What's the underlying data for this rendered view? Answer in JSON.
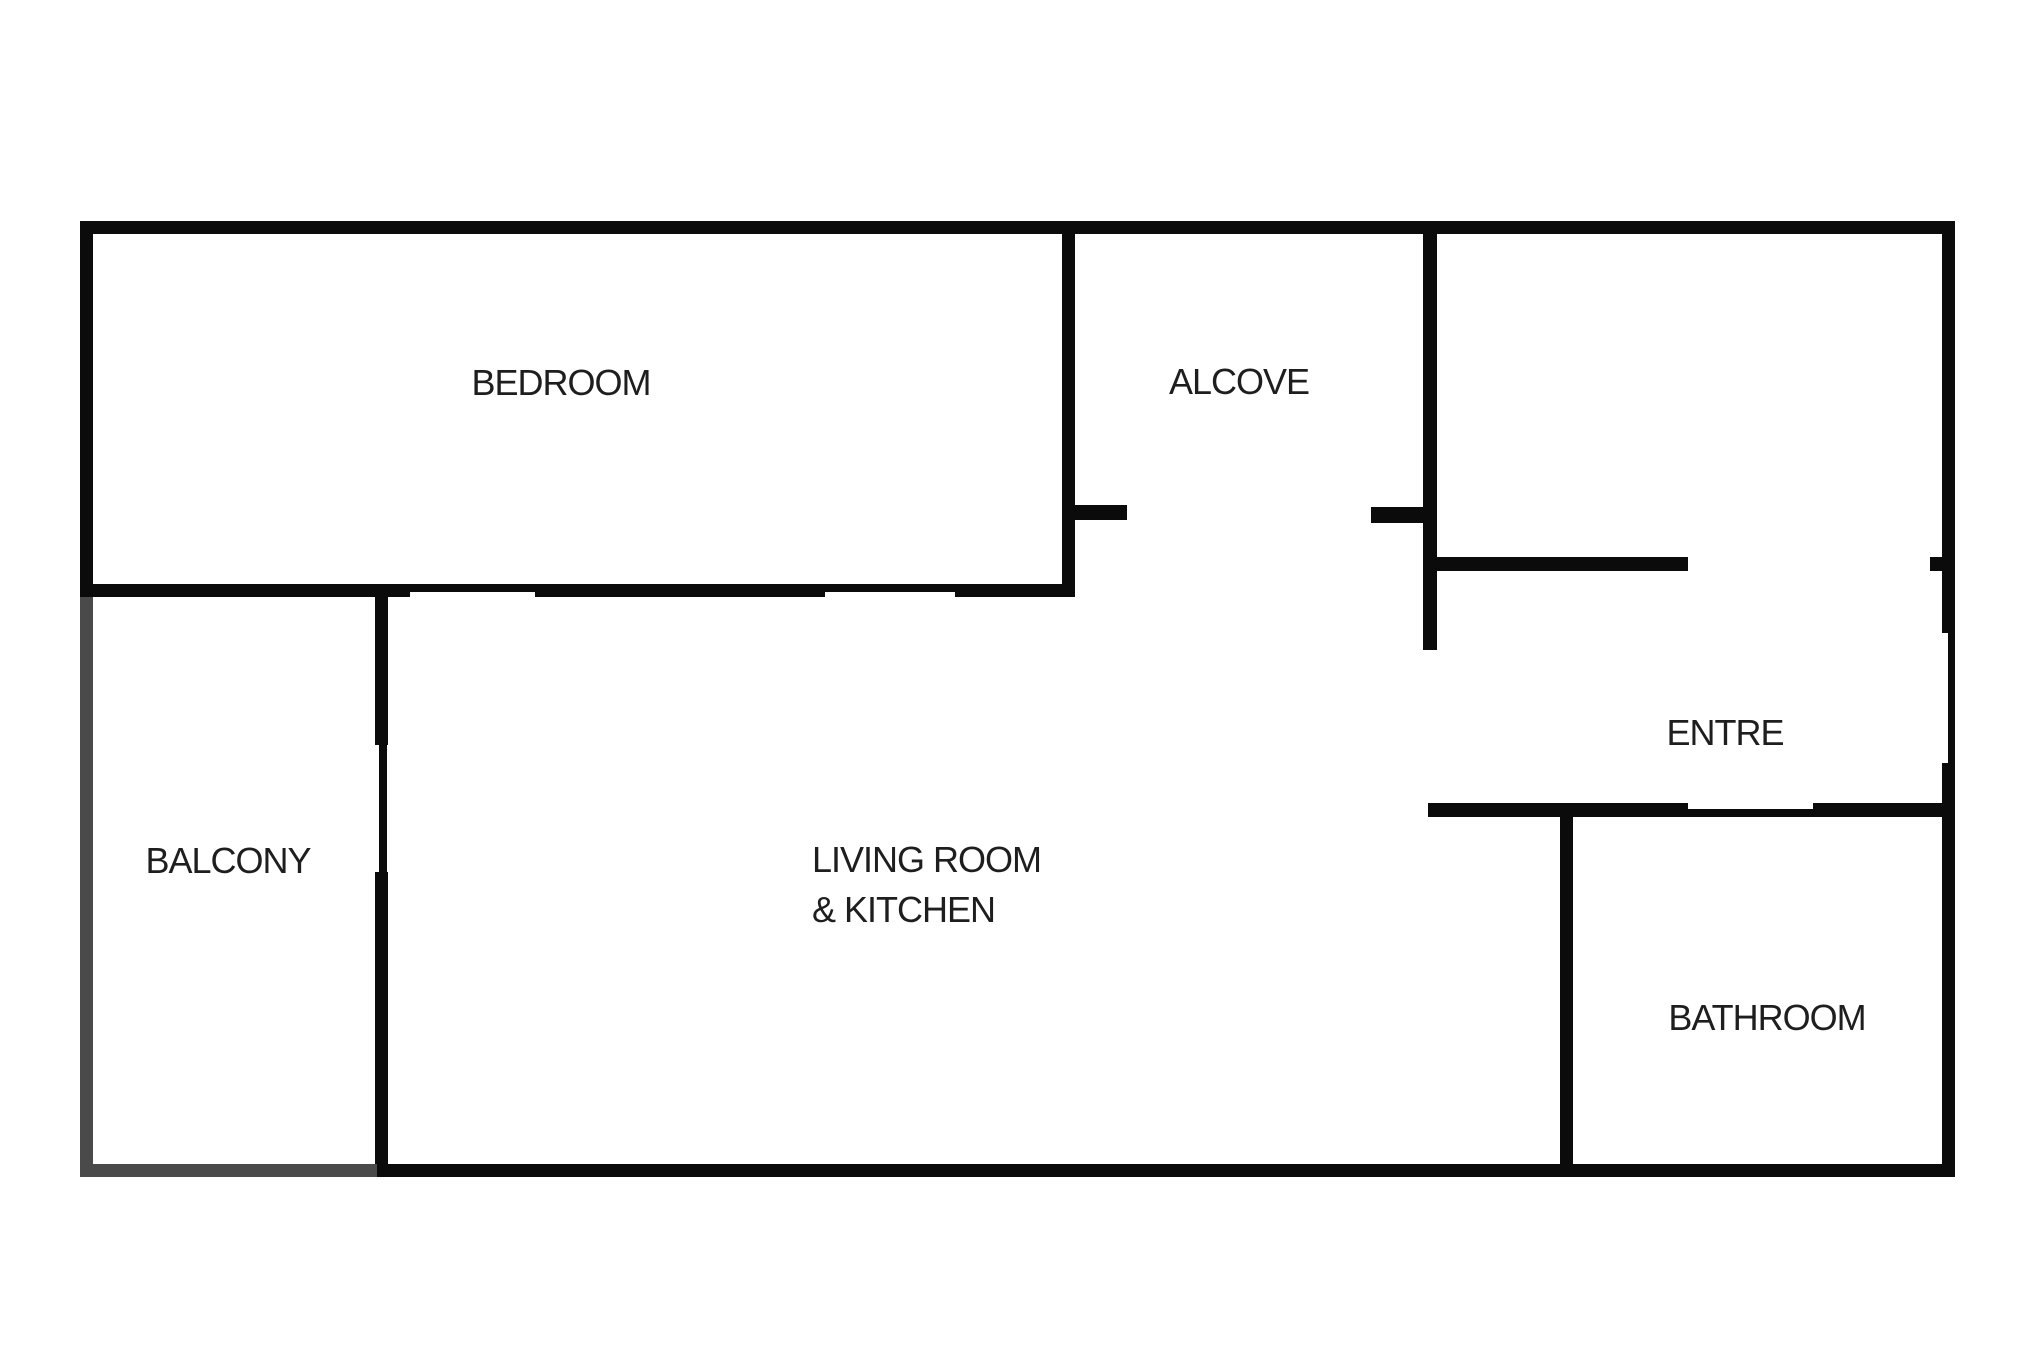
{
  "floorplan": {
    "colors": {
      "background": "#ffffff",
      "wall": "#0b0b0b",
      "open_wall": "#4a4a4a",
      "text": "#1e1e1e"
    },
    "rooms": {
      "bedroom": {
        "label": "BEDROOM"
      },
      "alcove": {
        "label": "ALCOVE"
      },
      "entre": {
        "label": "ENTRE"
      },
      "balcony": {
        "label": "BALCONY"
      },
      "living": {
        "label_line1": "LIVING ROOM",
        "label_line2": "& KITCHEN"
      },
      "bathroom": {
        "label": "BATHROOM"
      }
    },
    "walls": [
      {
        "name": "outer-top",
        "x": 80,
        "y": 221,
        "w": 1875,
        "h": 13
      },
      {
        "name": "outer-left-bedroom",
        "x": 80,
        "y": 221,
        "w": 13,
        "h": 376
      },
      {
        "name": "outer-right-upper",
        "x": 1942,
        "y": 221,
        "w": 13,
        "h": 412
      },
      {
        "name": "outer-right-entry-window",
        "x": 1948,
        "y": 633,
        "w": 7,
        "h": 130
      },
      {
        "name": "outer-right-lower",
        "x": 1942,
        "y": 763,
        "w": 13,
        "h": 414
      },
      {
        "name": "outer-bottom",
        "x": 377,
        "y": 1164,
        "w": 1578,
        "h": 13
      },
      {
        "name": "bedroom-south-a",
        "x": 80,
        "y": 584,
        "w": 330,
        "h": 13
      },
      {
        "name": "bedroom-window-west",
        "x": 410,
        "y": 584,
        "w": 125,
        "h": 8
      },
      {
        "name": "bedroom-south-b",
        "x": 535,
        "y": 584,
        "w": 290,
        "h": 13
      },
      {
        "name": "bedroom-window-east",
        "x": 825,
        "y": 584,
        "w": 130,
        "h": 8
      },
      {
        "name": "bedroom-south-c",
        "x": 955,
        "y": 584,
        "w": 120,
        "h": 13
      },
      {
        "name": "alcove-west",
        "x": 1062,
        "y": 233,
        "w": 13,
        "h": 364
      },
      {
        "name": "alcove-west-tick",
        "x": 1075,
        "y": 505,
        "w": 52,
        "h": 15
      },
      {
        "name": "alcove-east",
        "x": 1423,
        "y": 233,
        "w": 14,
        "h": 417
      },
      {
        "name": "alcove-east-tick",
        "x": 1371,
        "y": 507,
        "w": 52,
        "h": 16
      },
      {
        "name": "entre-north",
        "x": 1437,
        "y": 557,
        "w": 251,
        "h": 14
      },
      {
        "name": "entre-north-nub",
        "x": 1930,
        "y": 557,
        "w": 12,
        "h": 14
      },
      {
        "name": "balcony-divider-upper",
        "x": 375,
        "y": 597,
        "w": 13,
        "h": 148
      },
      {
        "name": "balcony-door",
        "x": 379,
        "y": 745,
        "w": 8,
        "h": 127
      },
      {
        "name": "balcony-divider-lower",
        "x": 375,
        "y": 872,
        "w": 13,
        "h": 293
      },
      {
        "name": "bathroom-north-west",
        "x": 1428,
        "y": 803,
        "w": 260,
        "h": 14
      },
      {
        "name": "bathroom-door",
        "x": 1688,
        "y": 809,
        "w": 125,
        "h": 8
      },
      {
        "name": "bathroom-north-east",
        "x": 1813,
        "y": 803,
        "w": 129,
        "h": 14
      },
      {
        "name": "bathroom-west",
        "x": 1560,
        "y": 803,
        "w": 13,
        "h": 362
      },
      {
        "name": "balcony-west-open",
        "x": 80,
        "y": 597,
        "w": 13,
        "h": 580,
        "open": true
      },
      {
        "name": "balcony-south-open",
        "x": 80,
        "y": 1164,
        "w": 297,
        "h": 13,
        "open": true
      }
    ]
  }
}
